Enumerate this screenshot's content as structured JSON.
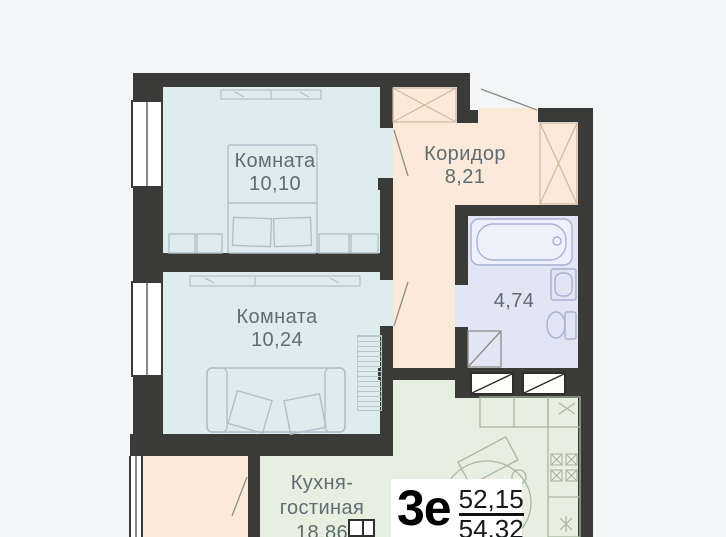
{
  "plan_badge": {
    "type_label": "3е",
    "living_area": "52,15",
    "total_area": "54,32"
  },
  "rooms": {
    "room1": {
      "name": "Комната",
      "area": "10,10"
    },
    "room2": {
      "name": "Комната",
      "area": "10,24"
    },
    "corridor": {
      "name": "Коридор",
      "area": "8,21"
    },
    "bathroom": {
      "area": "4,74"
    },
    "kitchen": {
      "name_line1": "Кухня-",
      "name_line2": "гостиная",
      "area": "18,86"
    }
  },
  "colors": {
    "bg": "#f2f6f7",
    "wall": "#3a3a38",
    "room": "#dfecee",
    "hall": "#fbe9d9",
    "bath": "#e1e5f4",
    "kitchen": "#e7efe0",
    "label_text": "#5f6d73",
    "badge_text": "#16191b"
  }
}
